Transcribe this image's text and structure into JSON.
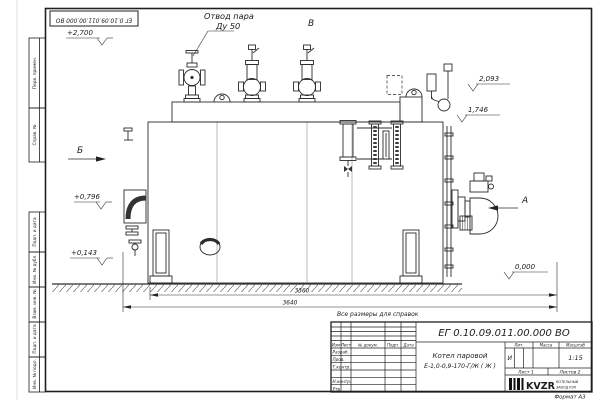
{
  "sheet": {
    "stamp_number": "ЕГ 0.10.09.011.00.000  ВО",
    "reference_note": "Все размеры для справок",
    "format_label": "Формат  А3"
  },
  "frame_labels": [
    "Перв. примен.",
    "Справ. №",
    "Подп. и дата",
    "Инв. № дубл.",
    "Взам. инв. №",
    "Подп. и дата",
    "Инв. № подл."
  ],
  "annotations": {
    "steam_line1": "Отвод пара",
    "steam_line2": "Ду 50",
    "view_v": "В",
    "view_b": "Б",
    "view_a": "А",
    "elev_2700": "+2,700",
    "elev_2093": "2,093",
    "elev_1746": "1,746",
    "elev_0796": "+0,796",
    "elev_0143": "+0,143",
    "elev_0000": "0,000",
    "dim_3360": "3360",
    "dim_3640": "3640"
  },
  "title_block": {
    "doc_number": "ЕГ 0.10.09.011.00.000  ВО",
    "header_cells": [
      "Изм",
      "Лист",
      "№ докум.",
      "Подп.",
      "Дата"
    ],
    "sign_rows": [
      "Разраб.",
      "Пров.",
      "Т.контр.",
      "Н.контр.",
      "Утв."
    ],
    "name_line1": "Котел паровой",
    "name_line2": "Е-1,0-0,9-170-Г/Ж ( Ж )",
    "lit_header": "Лит.",
    "mass_header": "Масса",
    "scale_header": "Масштаб",
    "lit_value": "И",
    "scale_value": "1:15",
    "sheet_cell": "Лист  1",
    "sheets_cell": "Листов  2",
    "logo_text": "KVZR",
    "logo_sub1": "КОТЕЛЬНЫЙ",
    "logo_sub2": "ЗАВОД РЭП"
  }
}
